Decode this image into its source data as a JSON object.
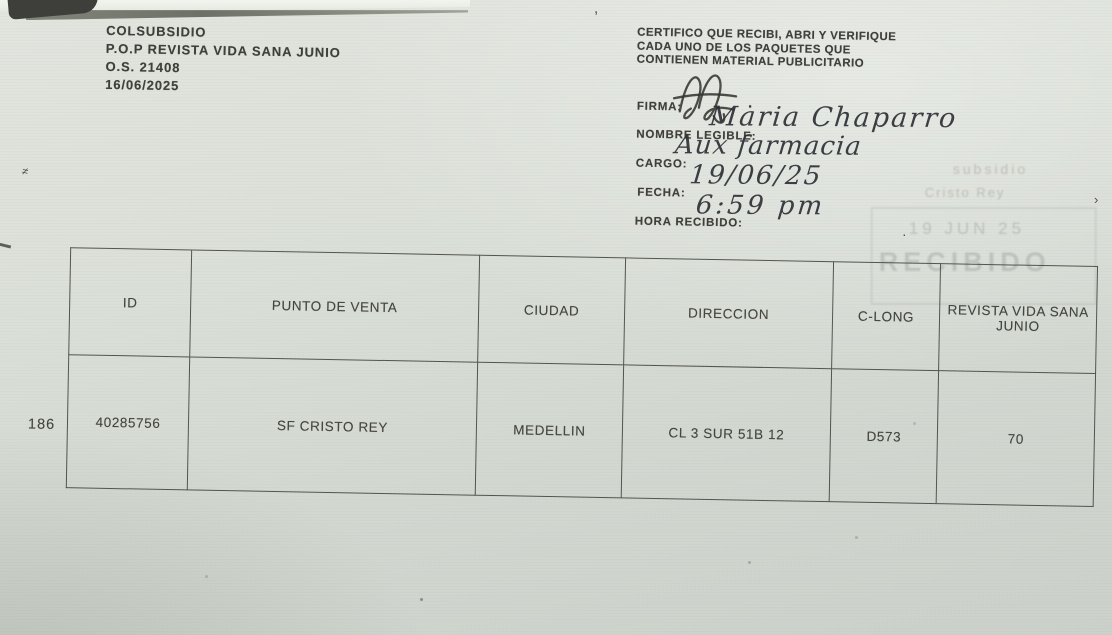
{
  "colors": {
    "paper": "#d8ddd5",
    "ink": "#3f3f39",
    "handwriting": "#2e2f35",
    "stamp": "#8f9a94",
    "table_border": "#53554c"
  },
  "header": {
    "company": "COLSUBSIDIO",
    "project": "P.O.P REVISTA VIDA SANA JUNIO",
    "order": "O.S. 21408",
    "date": "16/06/2025"
  },
  "certificate": {
    "statement_line1": "CERTIFICO QUE RECIBI, ABRI Y VERIFIQUE",
    "statement_line2": "CADA  UNO DE LOS PAQUETES QUE",
    "statement_line3": "CONTIENEN MATERIAL PUBLICITARIO",
    "firma_label": "FIRMA:",
    "firma_dot": ".",
    "nombre_label": "NOMBRE LEGIBLE:",
    "nombre_value": "Maria Chaparro",
    "cargo_label": "CARGO:",
    "cargo_value": "Aux farmacia",
    "fecha_label": "FECHA:",
    "fecha_value": "19/06/25",
    "hora_label": "HORA RECIBIDO:",
    "hora_value": "6:59 pm"
  },
  "stamp": {
    "line1": "subsidio",
    "line2": "Cristo Rey",
    "date": "19 JUN 25",
    "big_text": "RECIBIDO"
  },
  "table": {
    "row_number": "186",
    "headers": [
      "ID",
      "PUNTO DE VENTA",
      "CIUDAD",
      "DIRECCION",
      "C-LONG",
      "REVISTA VIDA SANA JUNIO"
    ],
    "rows": [
      {
        "id": "40285756",
        "punto_de_venta": "SF CRISTO REY",
        "ciudad": "MEDELLIN",
        "direccion": "CL 3 SUR 51B 12",
        "c_long": "D573",
        "revista": "70"
      }
    ]
  }
}
